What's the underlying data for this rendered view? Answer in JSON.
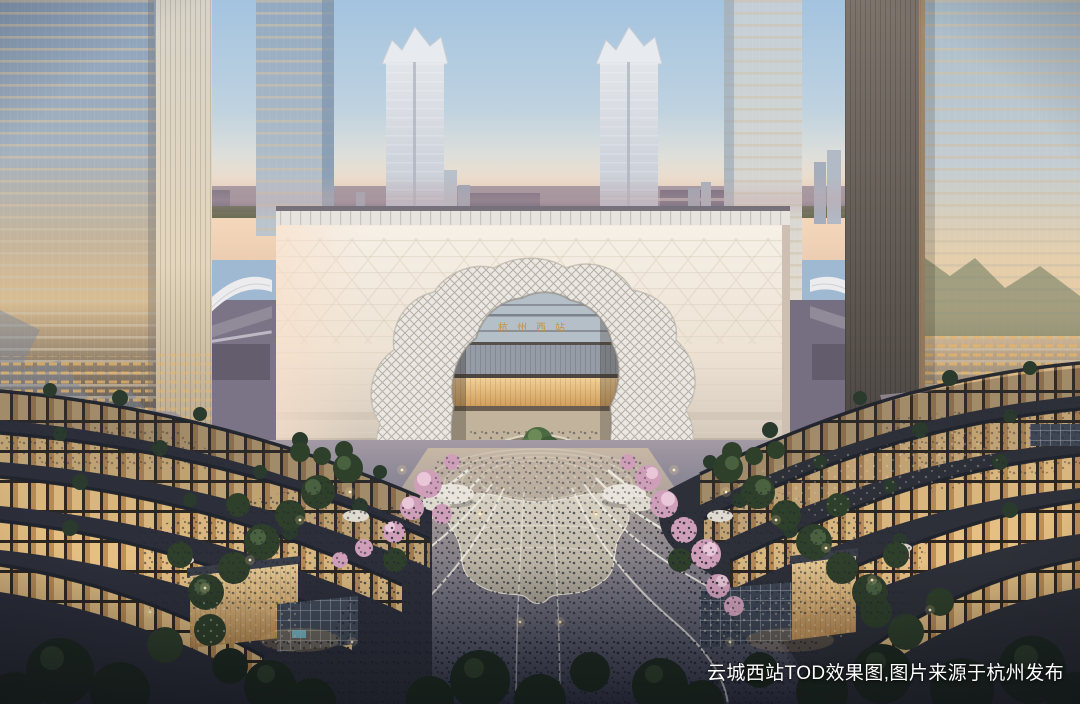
{
  "caption": {
    "text": "云城西站TOD效果图,图片来源于杭州发布"
  },
  "station": {
    "sign_text": "杭州西站",
    "sign_color": "#c8913e"
  },
  "palette": {
    "sky_top": "#a3c3df",
    "sky_horizon_pink": "#f6d9bc",
    "station_facade": "#f2ebe0",
    "arch_lattice": "#ebe8e3",
    "retail_glow": "#f0c887",
    "plaza_dusk": "#474c60",
    "pool_silver": "#d5cfc1",
    "blossom_pink": "#dfb3cb",
    "tree_green": "#3d5038",
    "caption_color": "#ffffff"
  }
}
